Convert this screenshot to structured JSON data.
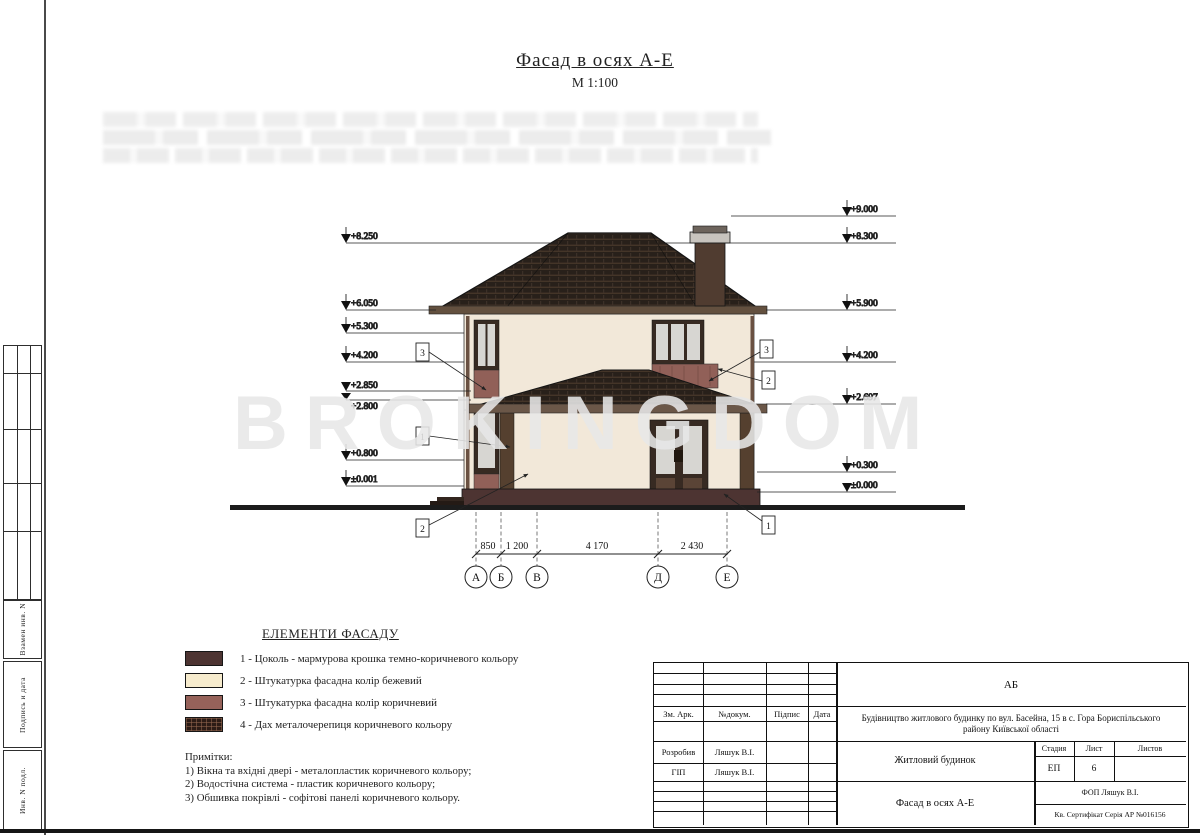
{
  "title": {
    "heading": "Фасад в осях А-Е",
    "scale": "М 1:100"
  },
  "watermark": "BROKINGDOM",
  "stamp_column": {
    "labels": [
      "Взамен инв. N",
      "Подпись и дата",
      "Инв. N подл."
    ]
  },
  "elevations": {
    "left": [
      "+8.250",
      "+6.050",
      "+5.300",
      "+4.200",
      "+2.850",
      "+2.800",
      "+0.800",
      "±0.001"
    ],
    "right": [
      "+9.000",
      "+8.300",
      "+5.900",
      "+4.200",
      "+2.697",
      "+0.300",
      "±0.000"
    ]
  },
  "axes": {
    "labels": [
      "А",
      "Б",
      "В",
      "Д",
      "Е"
    ],
    "dimensions": [
      "850",
      "1 200",
      "4 170",
      "2 430"
    ]
  },
  "callouts": {
    "left": [
      "3",
      "1",
      "2"
    ],
    "right": [
      "3",
      "2",
      "1"
    ]
  },
  "legend": {
    "heading": "ЕЛЕМЕНТИ ФАСАДУ",
    "items": [
      {
        "label": "1 - Цоколь - мармурова крошка темно-коричневого кольору",
        "color": "#4d3432"
      },
      {
        "label": "2 - Штукатурка фасадна колір бежевий",
        "color": "#f6ebcd"
      },
      {
        "label": "3 - Штукатурка фасадна колір коричневий",
        "color": "#96625a"
      },
      {
        "label": "4 - Дах металочерепиця коричневого кольору",
        "color": "#2c1c16"
      }
    ]
  },
  "notes": {
    "heading": "Примітки:",
    "lines": [
      "1) Вікна та вхідні двері - металопластик коричневого кольору;",
      "2) Водостічна система - пластик коричневого кольору;",
      "3) Обшивка покрівлі - софітові панелі коричневого кольору."
    ]
  },
  "titleblock": {
    "code": "АБ",
    "header_cols": [
      "Зм.  Арк.",
      "№докум.",
      "Підпис",
      "Дата"
    ],
    "project": "Будівництво житлового будинку по вул. Басейна, 15 в с. Гора Бориспільського району Київської області",
    "object": "Житловий будинок",
    "stage_label": "Стадия",
    "sheet_label": "Лист",
    "sheets_label": "Листов",
    "stage": "ЕП",
    "sheet": "6",
    "drawing_title": "Фасад в осях А-Е",
    "roles": [
      {
        "role": "Розробив",
        "name": "Ляшук В.І."
      },
      {
        "role": "ГІП",
        "name": "Ляшук В.І."
      }
    ],
    "firm": "ФОП Ляшук В.І.",
    "certificate": "Кв. Сертифікат Серія АР №016156"
  },
  "colors": {
    "roof": "#28201a",
    "wall": "#f2e8d9",
    "glass": "#d7d6d2",
    "frame": "#372a22",
    "plinth": "#4d3432",
    "brown_plaster": "#916058",
    "fascia": "#6b5748",
    "watermark": "#e7e7e7"
  }
}
